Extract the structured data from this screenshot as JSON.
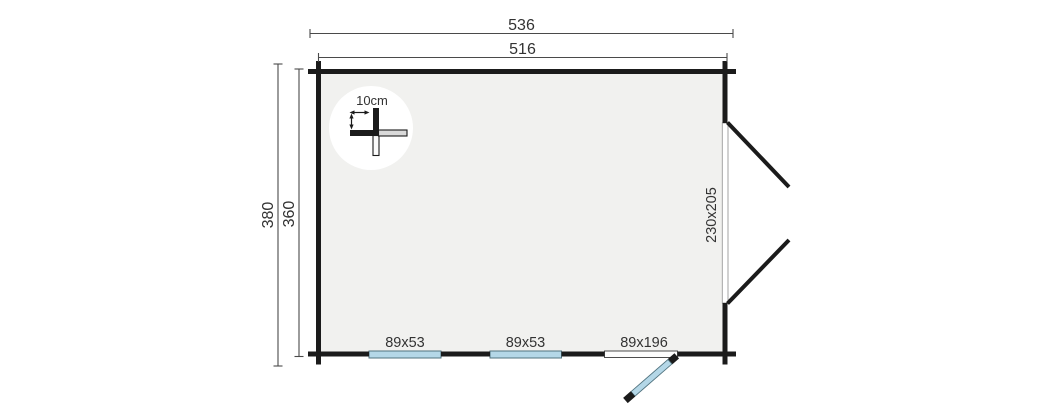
{
  "floorplan": {
    "dim_labels": {
      "overall_width": "536",
      "inner_width": "516",
      "overall_depth": "380",
      "inner_depth": "360"
    },
    "opening_labels": {
      "window_1": "89x53",
      "window_2": "89x53",
      "door": "89x196",
      "double_door": "230x205"
    },
    "detail": {
      "wall_thickness": "10cm"
    },
    "colors": {
      "wall": "#1b1b1b",
      "interior": "#f1f1ef",
      "glazing": "#b4d7e7",
      "glazing_border": "#51737f",
      "threshold": "#fcfcfc",
      "opening_band": "#ffffff",
      "dimension_line": "#4a4a4a",
      "text": "#333333"
    }
  }
}
